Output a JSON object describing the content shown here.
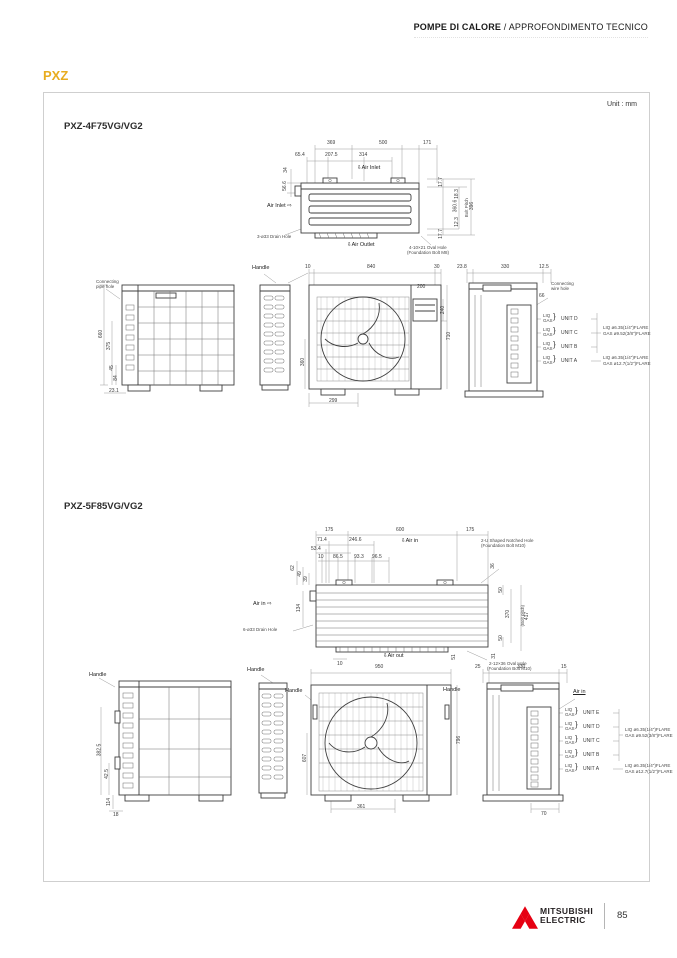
{
  "header": {
    "title_bold": "POMPE DI CALORE",
    "title_sep": " / ",
    "title_rest": "APPROFONDIMENTO TECNICO"
  },
  "page": {
    "series": "PXZ",
    "unit_note": "Unit : mm",
    "page_number": "85",
    "brand1": "MITSUBISHI",
    "brand2": "ELECTRIC"
  },
  "colors": {
    "accent": "#E8AC1E",
    "logo_red": "#E60012"
  },
  "s1": {
    "model": "PXZ-4F75VG/VG2",
    "top": {
      "d369": "369",
      "d500": "500",
      "d171": "171",
      "d654": "65.4",
      "d2075": "207.5",
      "d314": "314",
      "d34": "34",
      "d566": "56.6",
      "air_top": "⇩Air Inlet",
      "air_left": "Air Inlet ⇨",
      "air_out": "⇩Air Outlet",
      "drain": "3-ø33 Drain Hole",
      "r1": "17.7",
      "r2": "18.3",
      "r3": "360.6",
      "r3b": "Bolt Pitch",
      "r4": "396",
      "r5": "12.3",
      "r6": "17.7",
      "note1": "4-10×21 Oval Hole",
      "note2": "(Foundation Bolt M8)"
    },
    "back": {
      "conn1": "Connecting",
      "conn2": "pipe hole",
      "v1": "660",
      "v2": "375",
      "v3": "45",
      "v4": "84",
      "b1": "23.1"
    },
    "handle": "Handle",
    "front": {
      "t1": "10",
      "t2": "840",
      "t3": "30",
      "d200": "200",
      "d240": "240",
      "d710": "710",
      "d360": "360",
      "d299": "299"
    },
    "sider": {
      "t1": "23.8",
      "t2": "330",
      "t3": "12.5",
      "d66": "66",
      "wire1": "Connecting",
      "wire2": "wire hole",
      "liq": "LIQ",
      "gas": "GAS",
      "brace": "}",
      "u1": "UNIT D",
      "u2": "UNIT C",
      "u3": "UNIT B",
      "u4": "UNIT A",
      "sp1a": "LIQ  ø6.35(1/4\")FLARE",
      "sp1b": "GAS  ø9.52(3/8\")FLARE",
      "sp2a": "LIQ  ø6.35(1/4\")FLARE",
      "sp2b": "GAS  ø12.7(1/2\")FLARE"
    }
  },
  "s2": {
    "model": "PXZ-5F85VG/VG2",
    "top": {
      "t1": "175",
      "t2": "600",
      "t3": "175",
      "d714": "71.4",
      "d2466": "246.6",
      "d534": "53.4",
      "d10": "10",
      "d865": "86.5",
      "d933": "93.3",
      "d965": "96.5",
      "air_top": "⇩Air in",
      "air_left": "Air in ⇨",
      "air_out": "⇩Air out",
      "drain": "6-ø33 Drain Hole",
      "l1": "62",
      "l2": "49",
      "l3": "39",
      "l4": "134",
      "notch1": "2-U Shaped Notched Hole",
      "notch2": "(Foundation Bolt M10)",
      "r1": "36",
      "r2": "50",
      "r3": "370",
      "r3b": "(Bolt pitch)",
      "r4": "417",
      "r5": "50",
      "d51": "51",
      "b10": "10",
      "r7": "31",
      "oval1": "2-12×36 Oval Hole",
      "oval2": "(Foundation Bolt M10)"
    },
    "back": {
      "handle": "Handle",
      "v1": "382.5",
      "v2": "42.5",
      "v3": "114",
      "b1": "18"
    },
    "sideb": {
      "handle": "Handle"
    },
    "front": {
      "d950": "950",
      "handle_l": "Handle",
      "handle_r": "Handle",
      "d796": "796",
      "d607": "607",
      "d361": "361"
    },
    "sider": {
      "t1": "25",
      "t2": "330",
      "t3": "15",
      "air": "Air in",
      "liq": "LIQ",
      "gas": "GAS",
      "brace": "}",
      "u1": "UNIT E",
      "u2": "UNIT D",
      "u3": "UNIT C",
      "u4": "UNIT B",
      "u5": "UNIT A",
      "sp1a": "LIQ  ø6.35(1/4\")FLARE",
      "sp1b": "GAS  ø9.52(3/8\")FLARE",
      "sp2a": "LIQ  ø6.35(1/4\")FLARE",
      "sp2b": "GAS  ø12.7(1/2\")FLARE",
      "d70": "70"
    }
  }
}
